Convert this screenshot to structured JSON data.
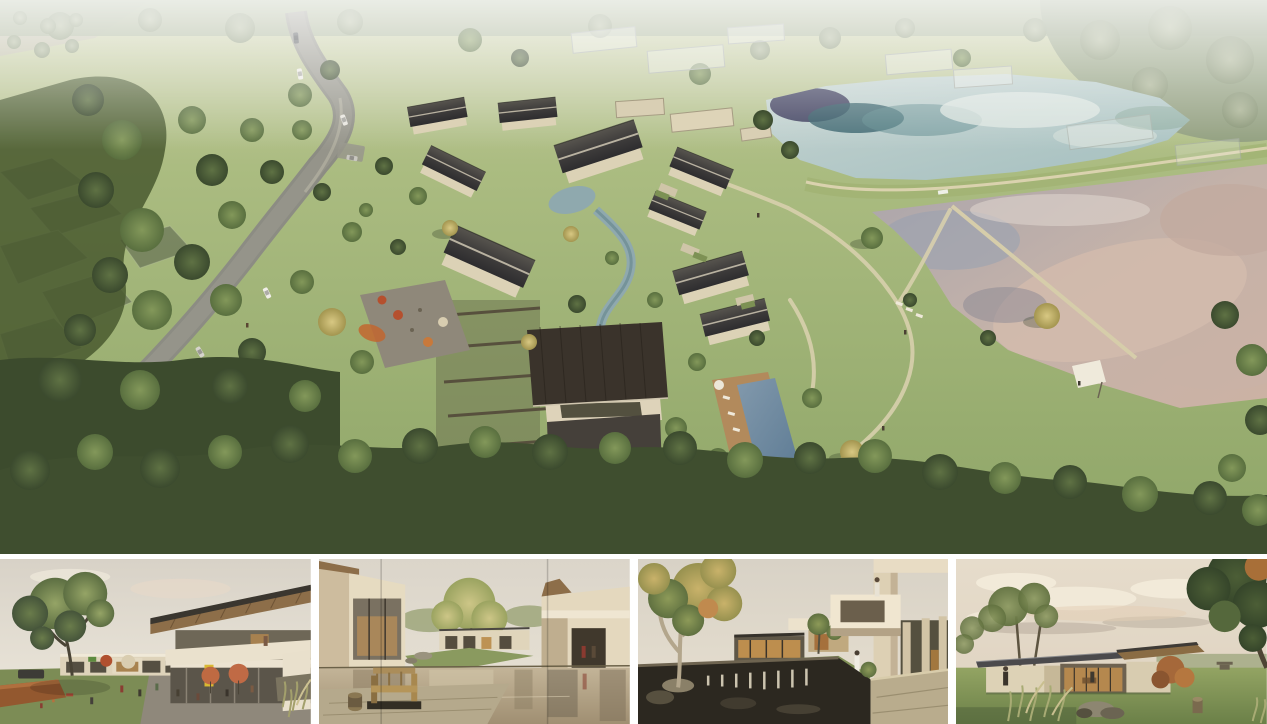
{
  "document": {
    "type": "architectural-rendering-presentation-board",
    "panel_count": 5
  },
  "panels": {
    "aerial": {
      "label": "Aerial masterplan rendering of a courtyard resort village beside two ponds, with a curving road, ghosted context buildings and meadows"
    },
    "street": {
      "label": "Eye-level rendering of the village street with cafe terrace, umbrellas and a large tree"
    },
    "pond": {
      "label": "Eye-level rendering of the courtyard reflecting pond with a wooden bench"
    },
    "cascade": {
      "label": "Eye-level rendering of the cascading pond courtyard with cantilevered balcony and autumn tree"
    },
    "pavilion": {
      "label": "Eye-level rendering of a single-storey glass pavilion on a lawn at dusk"
    }
  },
  "palette": {
    "page-bg": "#ffffff",
    "grass": "#a8b97f",
    "grass-deep": "#8ea567",
    "forest-dark": "#3f4e2f",
    "road-gray": "#8c8c83",
    "roof-dark": "#3f3d3c",
    "wall-beige": "#ddd3b8",
    "pond-upper": "#b5c8c6",
    "pond-lower": "#c4b2a9",
    "reflection-blue": "#2c2a4e",
    "reflection-teal": "#2e5a64",
    "pool-blue": "#6f89a0",
    "deck-wood": "#b28a5c",
    "path-beige": "#d8d0ad",
    "umbrella-red": "#b5502e",
    "umbrella-orange": "#c8793b",
    "sign-yellow": "#d9b832",
    "autumn-yellow": "#d8c883",
    "maple-red": "#a5683a",
    "sky-haze": "#ddd7cb"
  }
}
